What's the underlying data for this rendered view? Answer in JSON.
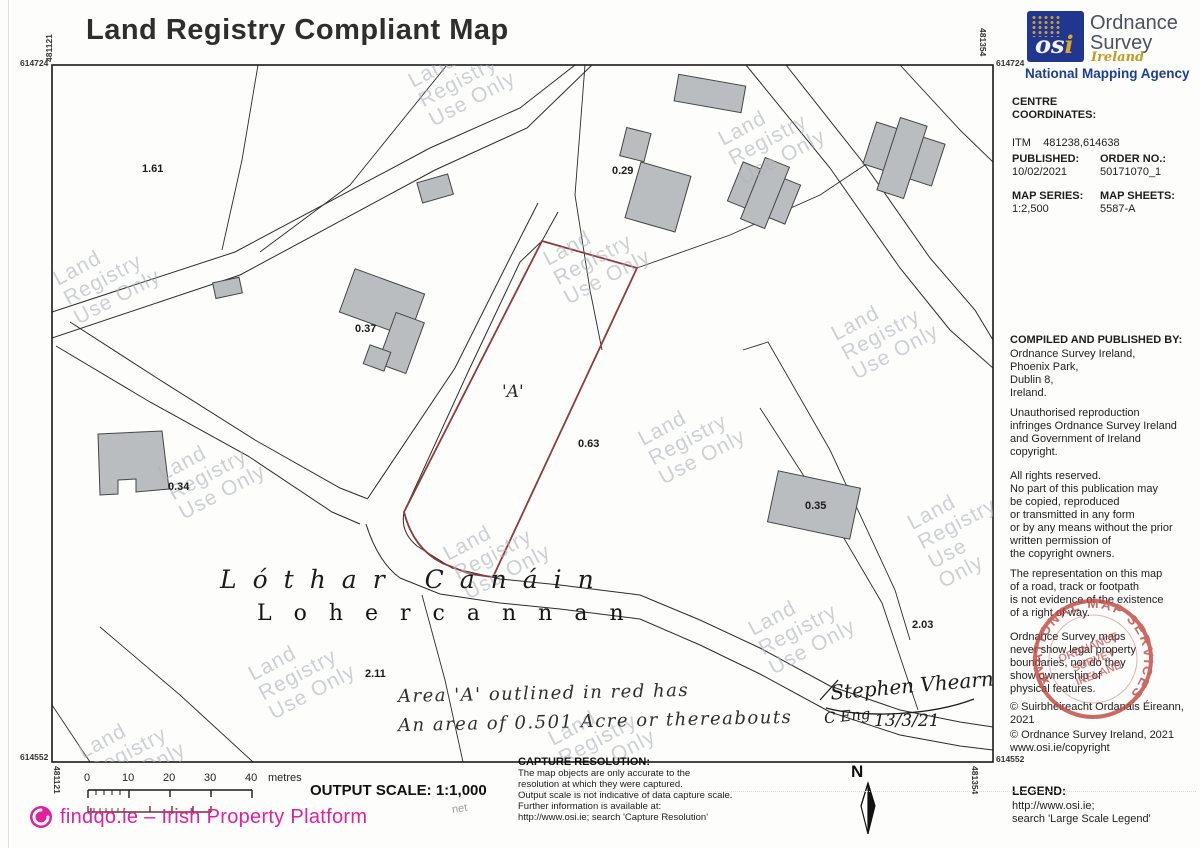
{
  "title": "Land Registry Compliant Map",
  "colors": {
    "parcel_outline_red": "#8e3b3d",
    "brand_magenta": "#e0219e",
    "osi_blue": "#20368f",
    "stamp_red": "#c0453e",
    "building_gray": "#b9bdbf"
  },
  "osi": {
    "logo_text": "os",
    "logo_text_i": "i",
    "name_line1": "Ordnance",
    "name_line2": "Survey",
    "name_line3": "Ireland",
    "tagline": "National Mapping Agency"
  },
  "info": {
    "centre_label": "CENTRE",
    "coordinates_label": "COORDINATES:",
    "itm_label": "ITM",
    "itm_value": "481238,614638",
    "published_label": "PUBLISHED:",
    "published_value": "10/02/2021",
    "order_label": "ORDER NO.:",
    "order_value": "50171070_1",
    "series_label": "MAP SERIES:",
    "series_value": "1:2,500",
    "sheets_label": "MAP SHEETS:",
    "sheets_value": "5587-A",
    "compiled_heading": "COMPILED AND PUBLISHED BY:",
    "compiled_lines": [
      "Ordnance Survey Ireland,",
      "Phoenix Park,",
      "Dublin 8,",
      "Ireland."
    ],
    "para_unauthorised": [
      "Unauthorised reproduction",
      "infringes Ordnance Survey Ireland",
      "and Government of Ireland",
      "copyright."
    ],
    "para_rights": [
      "All rights reserved.",
      "No part of this publication may",
      "be copied, reproduced",
      "or transmitted in any form",
      "or by any means without the prior",
      "written permission of",
      "the copyright owners."
    ],
    "para_representation": [
      "The representation on this map",
      "of a road, track or footpath",
      "is not evidence of the existence",
      "of a right of way."
    ],
    "para_boundaries": [
      "Ordnance Survey maps",
      "never show legal property",
      "boundaries, nor do they",
      "show ownership of",
      "physical features."
    ],
    "copyright_irish": [
      "© Suirbhéireacht Ordanáis Éireann,",
      " 2021"
    ],
    "copyright_english": "© Ordnance Survey Ireland,  2021",
    "copyright_url": "www.osi.ie/copyright",
    "legend_heading": "LEGEND:",
    "legend_lines": [
      "http://www.osi.ie;",
      "search 'Large Scale Legend'"
    ]
  },
  "stamp": {
    "arc_text": "NATIONAL MAP SERVICES",
    "line1": "ORDNANCE",
    "line2": "SURVEY",
    "line3": "IRELAND"
  },
  "map": {
    "corners": {
      "tl_v": "481121",
      "tl_h": "614724",
      "tr_v": "481354",
      "tr_h": "614724",
      "bl_v": "481121",
      "bl_h": "614552",
      "br_v": "481354",
      "br_h": "614552"
    },
    "parcels": [
      "1.61",
      "0.29",
      "0.37",
      "0.63",
      "0.34",
      "0.35",
      "2.11",
      "2.03"
    ],
    "area_marker": "'A'",
    "townland_irish": "Lóthar Canáin",
    "townland_english": "Lohercannan",
    "watermark_lines": [
      "Land",
      "Registry",
      "Use Only"
    ],
    "annotation_line1": "Area 'A' outlined in red has",
    "annotation_line2": "An area of 0.501 Acre or thereabouts",
    "signature_name": "Stephen Vhearne",
    "signature_credential": "C Eng",
    "signature_date": "13/3/21"
  },
  "footer": {
    "scale_ticks": [
      "0",
      "10",
      "20",
      "30",
      "40"
    ],
    "scale_unit": "metres",
    "output_scale_label": "OUTPUT SCALE:",
    "output_scale_value": "1:1,000",
    "capture_heading": "CAPTURE RESOLUTION:",
    "capture_lines": [
      "The map objects are only accurate to the",
      "resolution at which they were captured.",
      "Output scale is not indicative of data capture scale.",
      "Further information is available at:",
      "http://www.osi.ie; search 'Capture Resolution'"
    ],
    "north_label": "N",
    "branding": "findqo.ie – Irish Property Platform",
    "branding_suffix": "net"
  }
}
